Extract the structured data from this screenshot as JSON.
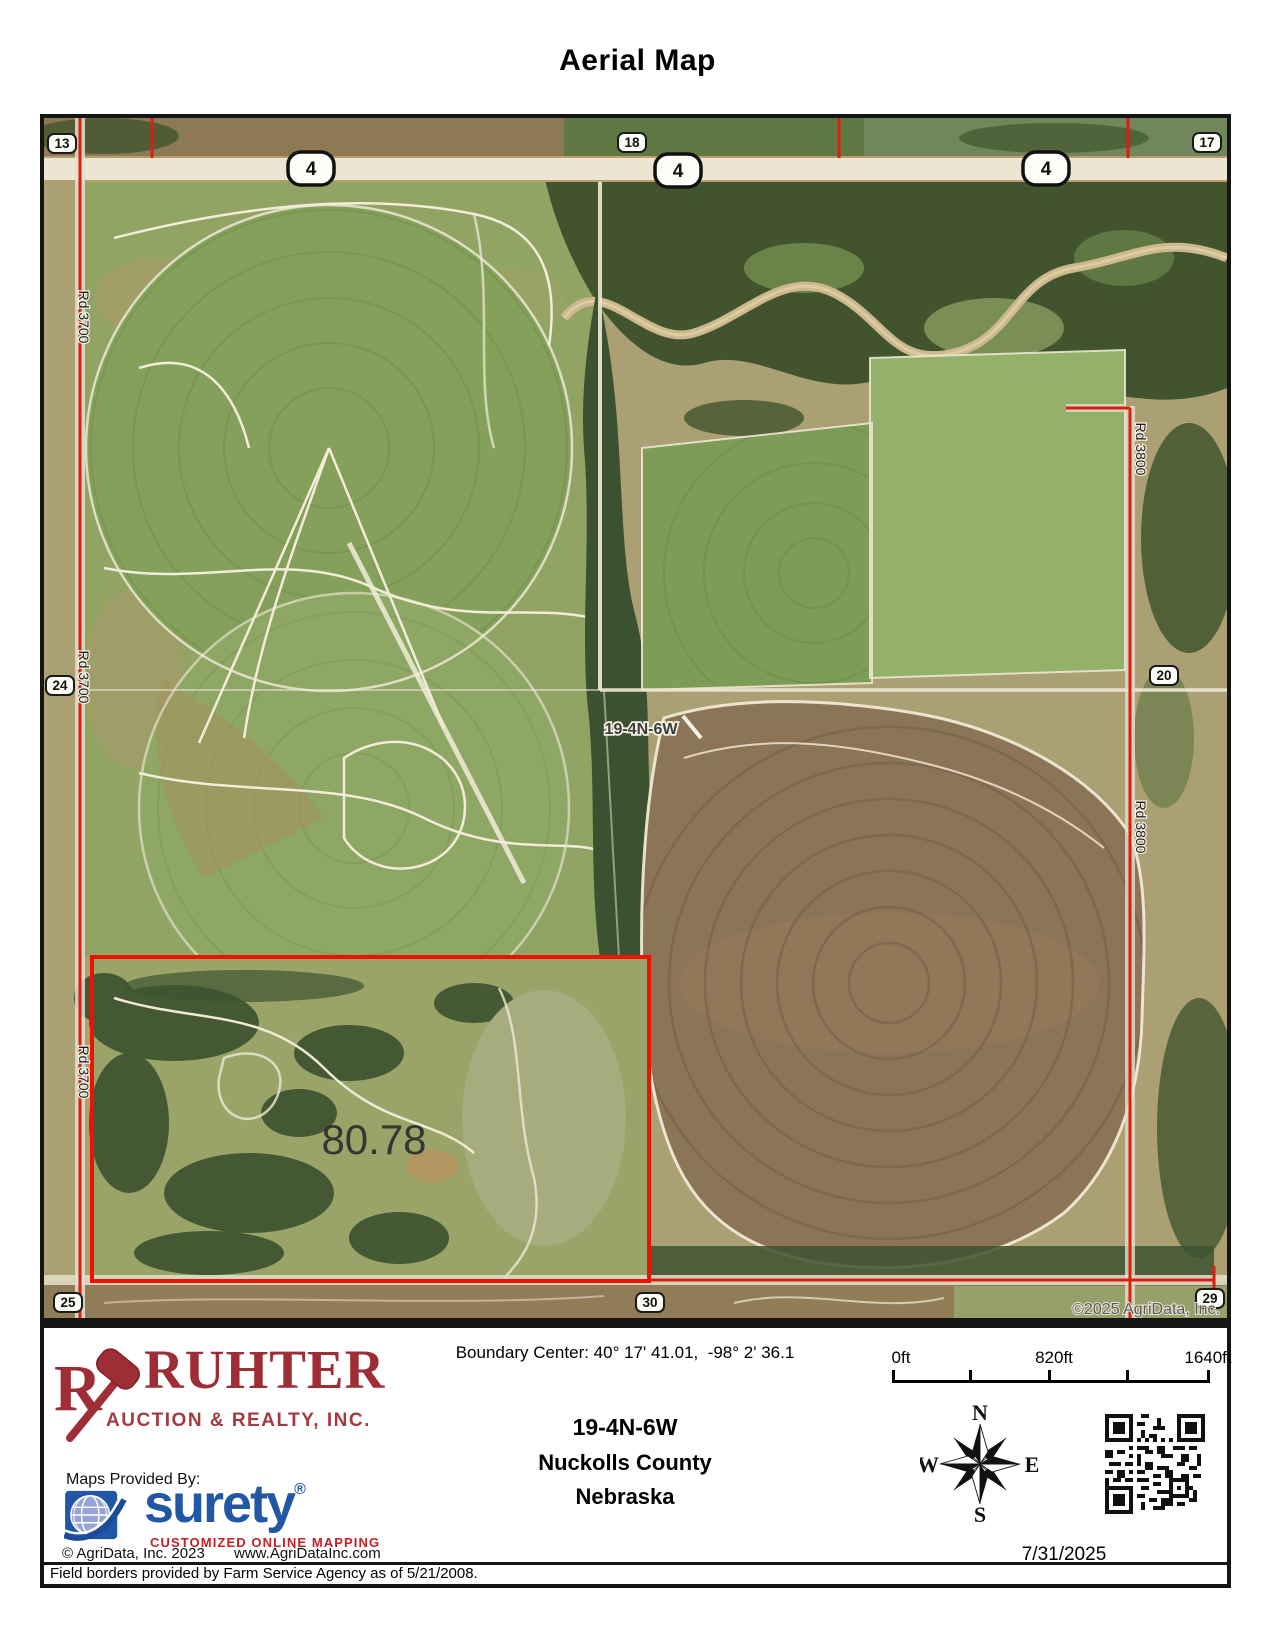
{
  "page_title": "Aerial Map",
  "map": {
    "highway_shield": "4",
    "sections": [
      "13",
      "18",
      "17",
      "24",
      "20",
      "25",
      "30",
      "29"
    ],
    "road_names": [
      "Rd 3700",
      "Rd 3800"
    ],
    "township_label": "19-4N-6W",
    "acreage_label": "80.78",
    "watermark": "©2025 AgriData, Inc."
  },
  "footer": {
    "company": {
      "name": "RUHTER",
      "subtitle": "AUCTION & REALTY, INC."
    },
    "maps_provided_by": "Maps Provided By:",
    "surety": {
      "wordmark": "surety",
      "registered": "®",
      "tagline": "CUSTOMIZED ONLINE MAPPING"
    },
    "agridata_copyright": "© AgriData, Inc. 2023",
    "agridata_url": "www.AgriDataInc.com",
    "field_note": "Field borders provided by Farm Service Agency as of 5/21/2008.",
    "boundary_center": "Boundary Center: 40° 17' 41.01,  -98° 2' 36.1",
    "township": "19-4N-6W",
    "county": "Nuckolls County",
    "state": "Nebraska",
    "scale_labels": [
      "0ft",
      "820ft",
      "1640ft"
    ],
    "compass": {
      "n": "N",
      "e": "E",
      "s": "S",
      "w": "W"
    },
    "date": "7/31/2025"
  },
  "colors": {
    "brand_maroon": "#9e2d35",
    "surety_blue": "#2257a5",
    "surety_red": "#c32128",
    "boundary_red": "#ee1202",
    "road_red": "#d81f11"
  }
}
